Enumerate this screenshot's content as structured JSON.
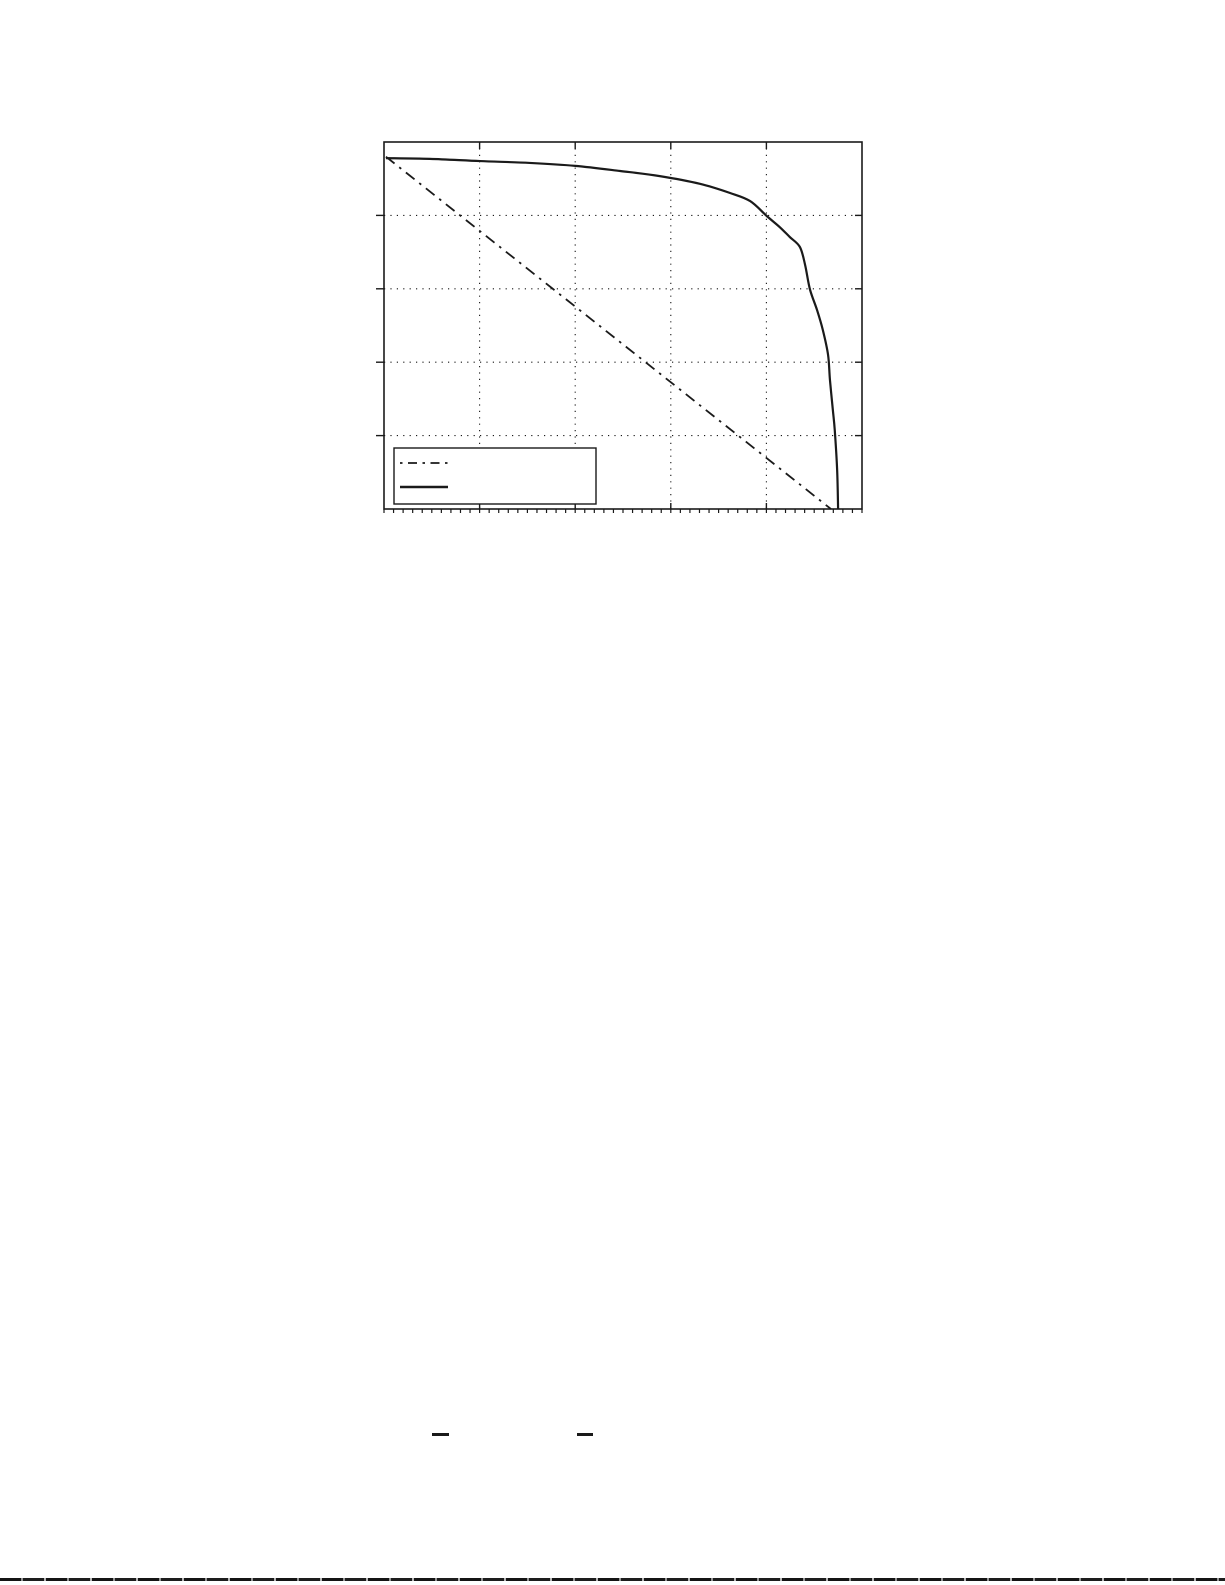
{
  "page": {
    "background_color": "#ffffff",
    "ink_color": "#1a1a1a"
  },
  "chart_data": {
    "type": "line",
    "title": "",
    "xlabel": "",
    "ylabel": "",
    "xlim": [
      0,
      1
    ],
    "ylim": [
      0,
      1
    ],
    "x_gridlines": [
      0.2,
      0.4,
      0.6,
      0.8
    ],
    "y_gridlines": [
      0.2,
      0.4,
      0.6,
      0.8
    ],
    "grid_style": "dotted",
    "tick_labels_visible": false,
    "x_minor_tick_step": 0.02,
    "legend": {
      "position": "lower-left",
      "entries": [
        {
          "label": "",
          "line_style": "dash-dot"
        },
        {
          "label": "",
          "line_style": "solid"
        }
      ]
    },
    "series": [
      {
        "name": "diagonal-reference-line",
        "line_style": "dash-dot",
        "color": "#1a1a1a",
        "points": [
          [
            0.004,
            0.96
          ],
          [
            0.935,
            0.0
          ]
        ]
      },
      {
        "name": "performance-curve",
        "line_style": "solid",
        "color": "#1a1a1a",
        "points": [
          [
            0.004,
            0.956
          ],
          [
            0.096,
            0.954
          ],
          [
            0.201,
            0.948
          ],
          [
            0.305,
            0.943
          ],
          [
            0.4,
            0.935
          ],
          [
            0.494,
            0.921
          ],
          [
            0.577,
            0.907
          ],
          [
            0.661,
            0.886
          ],
          [
            0.724,
            0.861
          ],
          [
            0.766,
            0.839
          ],
          [
            0.801,
            0.798
          ],
          [
            0.828,
            0.768
          ],
          [
            0.849,
            0.741
          ],
          [
            0.87,
            0.714
          ],
          [
            0.881,
            0.665
          ],
          [
            0.891,
            0.599
          ],
          [
            0.906,
            0.542
          ],
          [
            0.918,
            0.488
          ],
          [
            0.929,
            0.42
          ],
          [
            0.933,
            0.351
          ],
          [
            0.939,
            0.27
          ],
          [
            0.943,
            0.215
          ],
          [
            0.948,
            0.106
          ],
          [
            0.95,
            0.0
          ]
        ]
      }
    ]
  },
  "page_marks": {
    "equation_fraction_bars": [
      {
        "description": "short horizontal fraction bar"
      },
      {
        "description": "short horizontal fraction bar"
      }
    ],
    "bottom_edge_rule": {
      "description": "thin dark broken rule across bottom of page"
    }
  }
}
